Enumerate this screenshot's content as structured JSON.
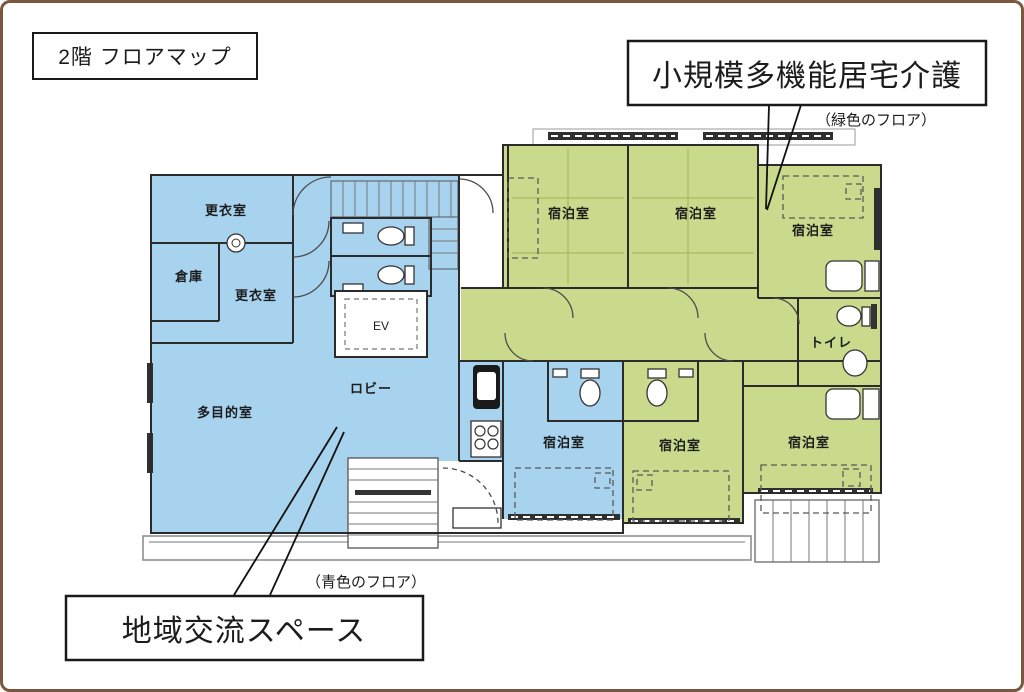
{
  "page": {
    "title": "2階 フロアマップ"
  },
  "legend": {
    "green": {
      "label": "小規模多機能居宅介護",
      "caption": "（緑色のフロア）"
    },
    "blue": {
      "label": "地域交流スペース",
      "caption": "（青色のフロア）"
    }
  },
  "rooms": [
    {
      "id": "changing-room-upper",
      "label": "更衣室",
      "zone": "blue"
    },
    {
      "id": "storage",
      "label": "倉庫",
      "zone": "blue"
    },
    {
      "id": "changing-room-lower",
      "label": "更衣室",
      "zone": "blue"
    },
    {
      "id": "elevator",
      "label": "EV",
      "zone": "none"
    },
    {
      "id": "lobby",
      "label": "ロビー",
      "zone": "blue"
    },
    {
      "id": "multipurpose-room",
      "label": "多目的室",
      "zone": "blue"
    },
    {
      "id": "guest-room-top-left",
      "label": "宿泊室",
      "zone": "green"
    },
    {
      "id": "guest-room-top-middle",
      "label": "宿泊室",
      "zone": "green"
    },
    {
      "id": "guest-room-top-right",
      "label": "宿泊室",
      "zone": "green"
    },
    {
      "id": "toilet",
      "label": "トイレ",
      "zone": "green"
    },
    {
      "id": "guest-room-bottom-left",
      "label": "宿泊室",
      "zone": "blue"
    },
    {
      "id": "guest-room-bottom-middle",
      "label": "宿泊室",
      "zone": "green"
    },
    {
      "id": "guest-room-bottom-right",
      "label": "宿泊室",
      "zone": "green"
    }
  ],
  "colors": {
    "blue_floor": "#a7d3ef",
    "green_floor": "#c9da8c",
    "frame_border": "#7a573f",
    "wall": "#2b2b2b"
  }
}
